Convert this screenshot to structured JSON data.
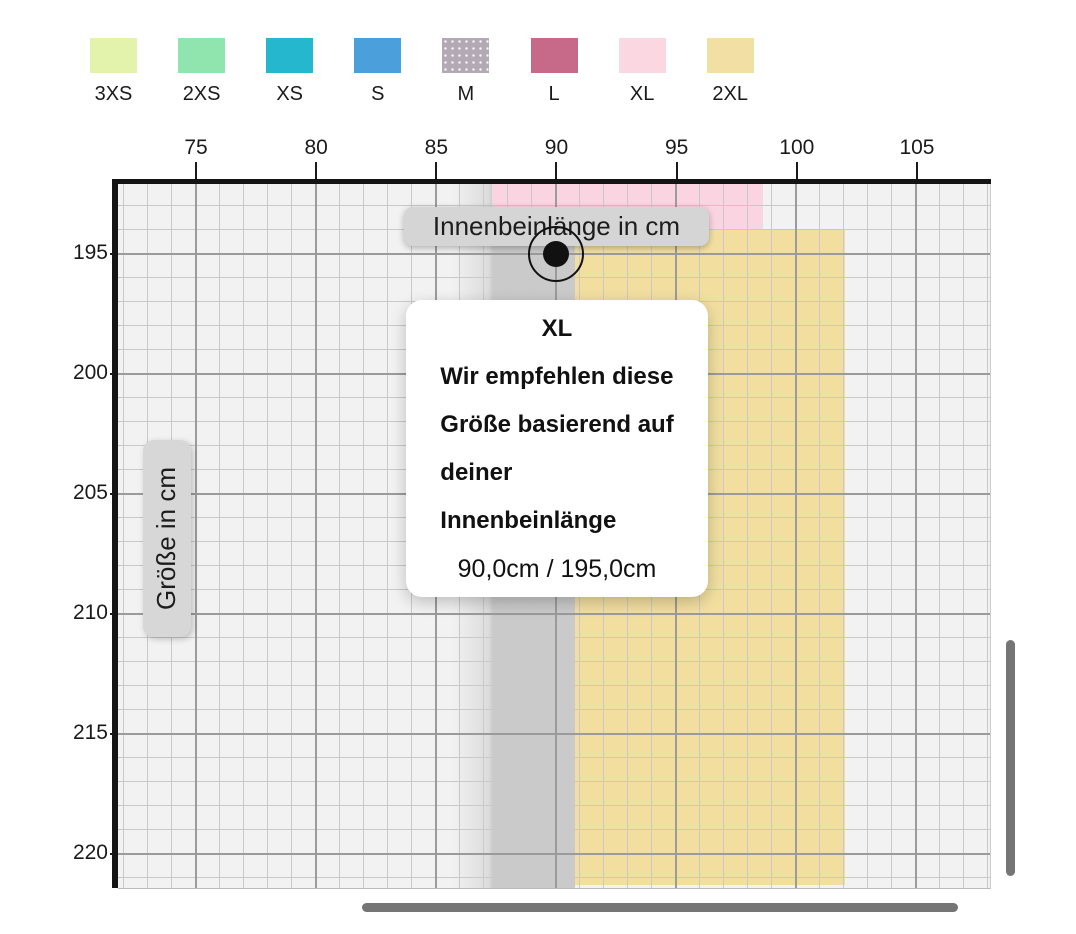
{
  "legend": {
    "items": [
      {
        "label": "3XS",
        "color": "#e3f3ab"
      },
      {
        "label": "2XS",
        "color": "#8fe5ad"
      },
      {
        "label": "XS",
        "color": "#25b7cd"
      },
      {
        "label": "S",
        "color": "#4b9fdb"
      },
      {
        "label": "M",
        "color": "#b3a9b5",
        "pattern": "dots"
      },
      {
        "label": "L",
        "color": "#c76989"
      },
      {
        "label": "XL",
        "color": "#fbd7e2"
      },
      {
        "label": "2XL",
        "color": "#f2dfa3"
      }
    ]
  },
  "chart_data": {
    "type": "area",
    "title": "",
    "xlabel": "Innenbeinlänge in cm",
    "ylabel": "Größe in cm",
    "x_ticks": [
      75,
      80,
      85,
      90,
      95,
      100,
      105
    ],
    "y_ticks": [
      195,
      200,
      205,
      210,
      215,
      220
    ],
    "x_range_visible": [
      71.7,
      108.1
    ],
    "y_range_visible": [
      192.1,
      221.3
    ],
    "grid": "on",
    "legend_position": "top",
    "regions": [
      {
        "size": "XL",
        "color": "#fad4e0",
        "x": [
          87.3,
          98.6
        ],
        "y": [
          192.1,
          194.0
        ]
      },
      {
        "size": "2XL",
        "color": "#f2dfa0",
        "x": [
          90.75,
          102.0
        ],
        "y": [
          194.0,
          221.3
        ]
      }
    ],
    "highlight_band": {
      "x": [
        85.6,
        90.75
      ]
    },
    "marker": {
      "x": 90.0,
      "y": 195.0
    }
  },
  "axis_pills": {
    "x": "Innenbeinlänge in cm",
    "y": "Größe in cm"
  },
  "tooltip": {
    "size": "XL",
    "message_lines": [
      "Wir empfehlen diese",
      "Größe basierend auf",
      "deiner",
      "Innenbeinlänge"
    ],
    "values": "90,0cm / 195,0cm"
  },
  "colors": {
    "plot_background": "#f2f2f2",
    "grid_minor": "#c9c9c9",
    "grid_major": "#9b9b9b",
    "axis_border": "#141414",
    "pill_background": "#d5d5d5",
    "tooltip_background": "#ffffff",
    "scrollbar": "#757575",
    "marker": "#111111"
  }
}
